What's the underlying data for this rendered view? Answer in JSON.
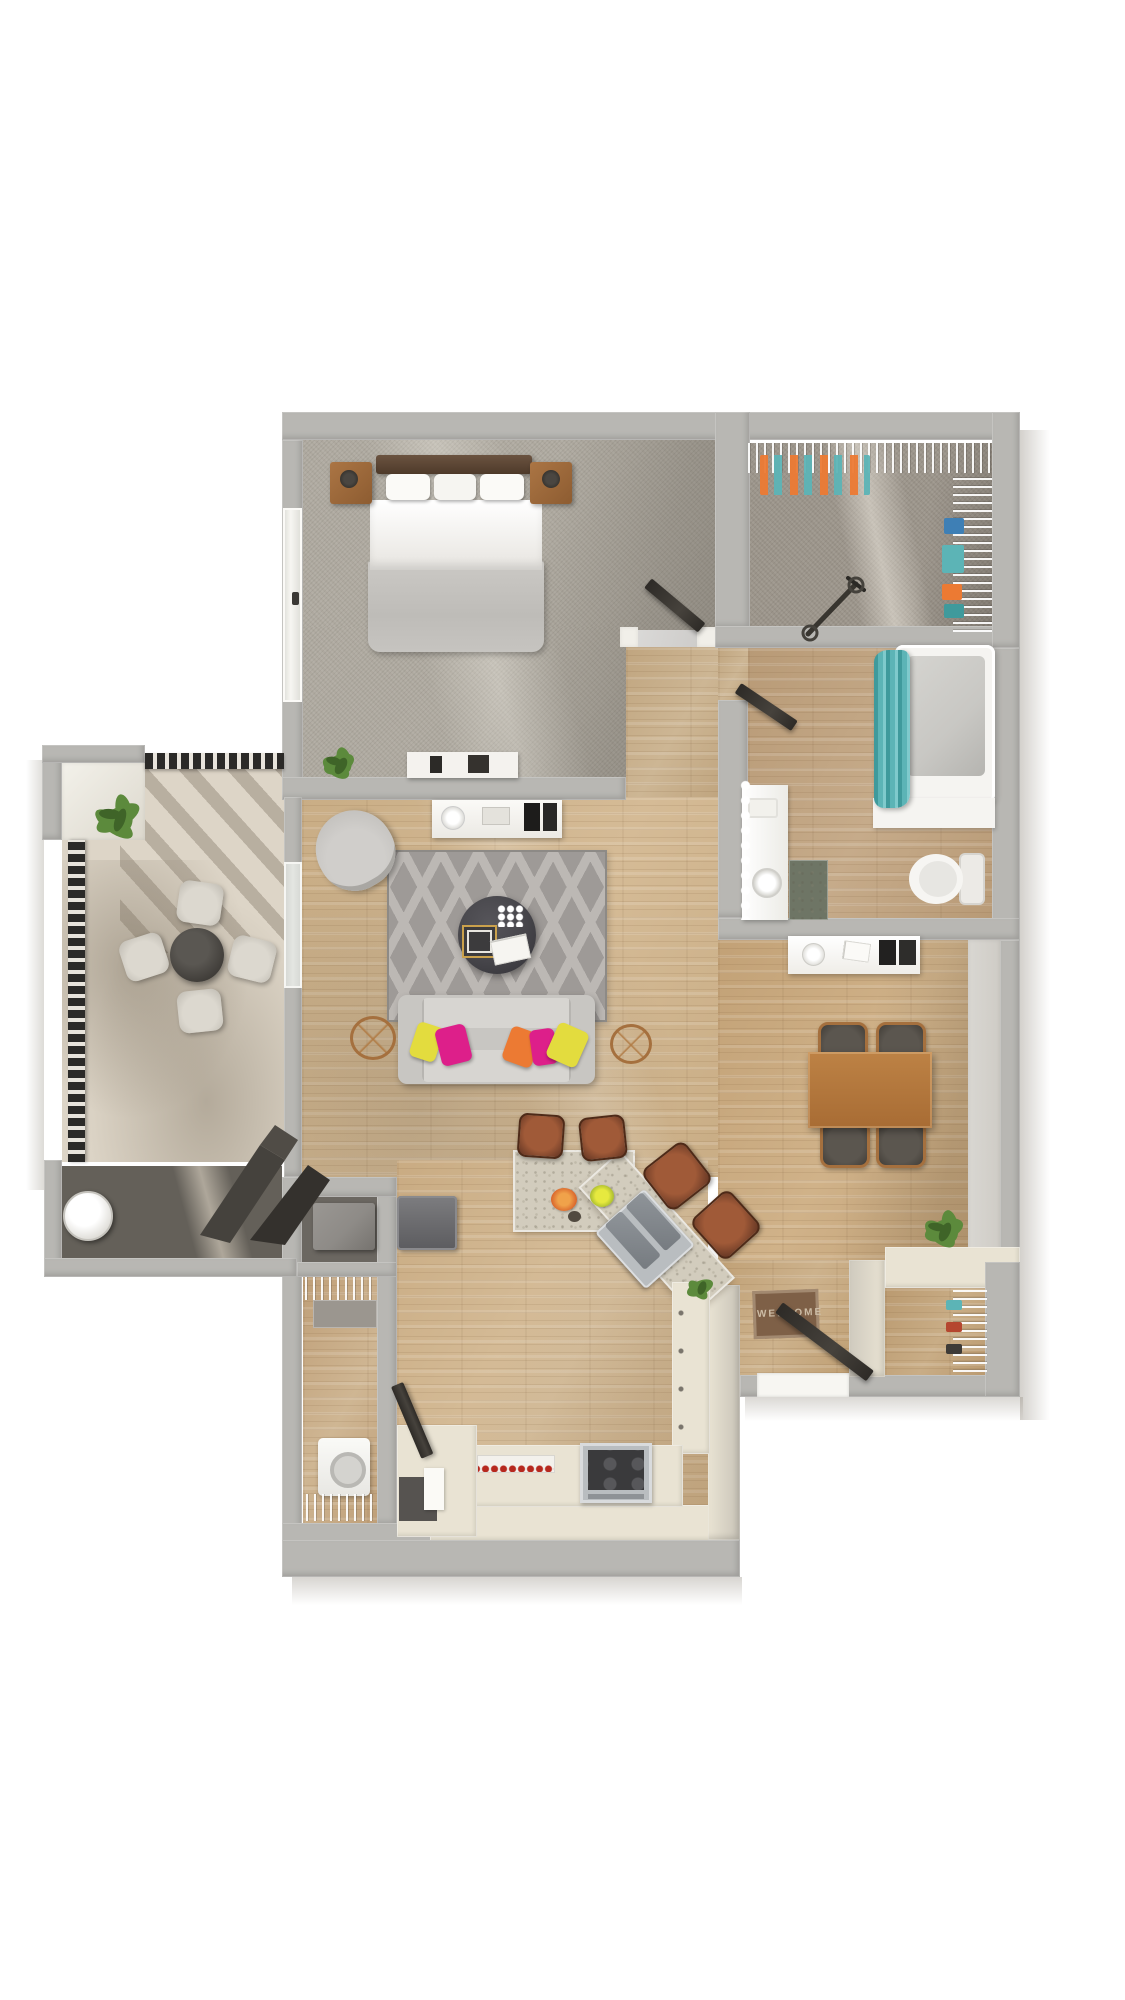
{
  "meta": {
    "kind": "3d-rendered-floor-plan",
    "view": "top-down-dollhouse",
    "unit": "one-bedroom-apartment"
  },
  "entry_mat": {
    "text": "WELCOME"
  },
  "rooms": [
    {
      "name": "bedroom",
      "floor": "carpet"
    },
    {
      "name": "walk-in-closet",
      "floor": "carpet"
    },
    {
      "name": "bathroom",
      "floor": "wood"
    },
    {
      "name": "hallway",
      "floor": "wood"
    },
    {
      "name": "living-room",
      "floor": "wood"
    },
    {
      "name": "dining-area",
      "floor": "wood"
    },
    {
      "name": "kitchen",
      "floor": "wood"
    },
    {
      "name": "laundry-room",
      "floor": "wood"
    },
    {
      "name": "entry",
      "floor": "wood"
    },
    {
      "name": "coat-closet",
      "floor": "wood"
    },
    {
      "name": "balcony-patio",
      "floor": "concrete"
    },
    {
      "name": "patio-storage",
      "floor": "concrete"
    }
  ],
  "palette": {
    "wall": "#b8b7b3",
    "wallFace": "#f1efe9",
    "cream": "#e9e3d3",
    "woodA": "#d5bb96",
    "woodB": "#c9ad85",
    "woodHallA": "#cdb694",
    "carpetA": "#aea99f",
    "carpetB": "#9b948a",
    "concrete": "#ddd5c7",
    "storageFloor": "#646059",
    "rug": "#9e9a97",
    "rugLine": "#bcb8b4",
    "sofa": "#c8c6c2",
    "sofaLight": "#d7d5d1",
    "pillowYellow": "#e3dc3e",
    "pillowMagenta": "#dd1f8a",
    "pillowOrange": "#ec7a33",
    "coffeeTable": "#46454a",
    "woodFurniture": "#a5703e",
    "leather": "#a05a38",
    "leatherDark": "#5f3322",
    "stainless": "#b9bdc0",
    "stainlessDark": "#8f9499",
    "fridge": "#6f6f72",
    "applianceGray": "#8e8b87",
    "teal": "#5cb4b6",
    "tealDark": "#3f9a9c",
    "porcelain": "#f5f4f1",
    "tubInner": "#c8c7c3",
    "doorPanel": "#46423c",
    "railing": "#2b2a28",
    "plantGreen": "#5c8a3c",
    "plantDark": "#3f6428",
    "matBrown": "#7e6047",
    "matText": "#cdbda6",
    "granite": "#d2ccbd",
    "graniteMat": "#6e7565",
    "glass": "#e4e6e2",
    "shadow": "#8d867a"
  }
}
